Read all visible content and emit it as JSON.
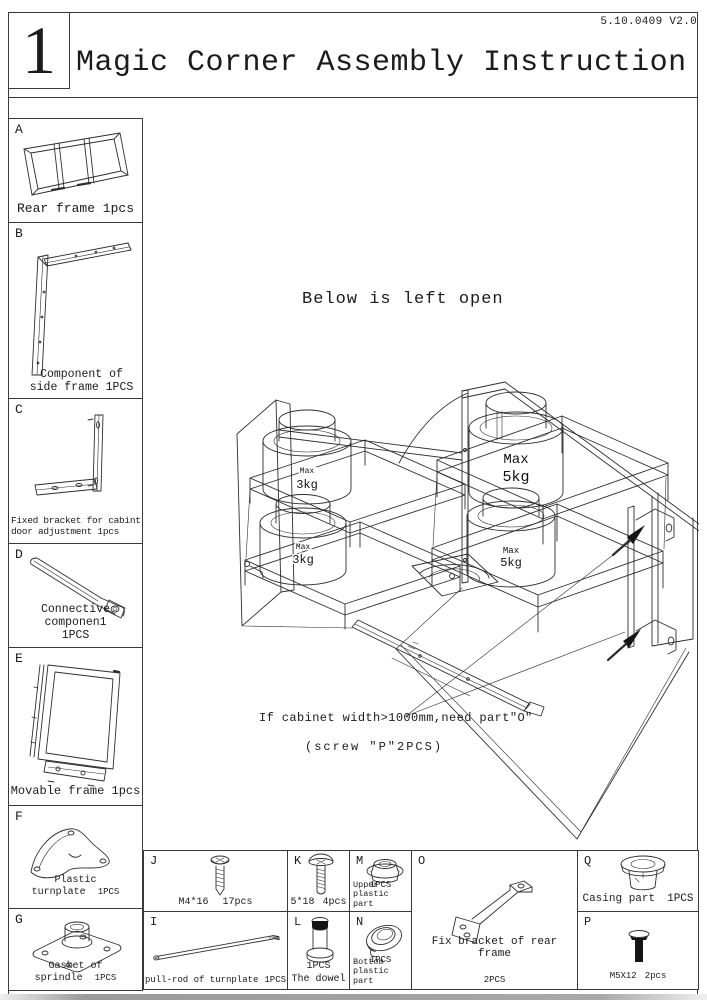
{
  "header": {
    "figure_number": "1",
    "title": "Magic Corner Assembly Instruction",
    "version": "5.10.0409 V2.0"
  },
  "side_parts": [
    {
      "id": "A",
      "caption": "Rear frame 1pcs"
    },
    {
      "id": "B",
      "caption": "Component of side frame 1PCS"
    },
    {
      "id": "C",
      "caption": "Fixed bracket for cabint door adjustment 1pcs"
    },
    {
      "id": "D",
      "caption": "Connective componen1",
      "qty": "1PCS"
    },
    {
      "id": "E",
      "caption": "Movable frame 1pcs"
    },
    {
      "id": "F",
      "caption": "Plastic turnplate",
      "qty": "1PCS"
    },
    {
      "id": "G",
      "caption": "Gasket of sprindle",
      "qty": "1PCS"
    }
  ],
  "bottom_parts": [
    {
      "id": "J",
      "label": "M4*16",
      "qty": "17pcs"
    },
    {
      "id": "K",
      "label": "5*18",
      "qty": "4pcs"
    },
    {
      "id": "M",
      "qty": "1PCS",
      "label": "Upper plastic part"
    },
    {
      "id": "O",
      "label": "Fix bracket of rear frame",
      "qty": "2PCS"
    },
    {
      "id": "Q",
      "label": "Casing part",
      "qty": "1PCS"
    },
    {
      "id": "I",
      "label": "pull-rod of turnplate",
      "qty": "1PCS"
    },
    {
      "id": "L",
      "qty": "1PCS",
      "label": "The dowel"
    },
    {
      "id": "N",
      "qty": "1PCS",
      "label": "Bottom plastic part"
    },
    {
      "id": "P",
      "label": "M5X12",
      "qty": "2pcs"
    }
  ],
  "diagram": {
    "note": "Below is left open",
    "annotation_line1": "If cabinet width>1000mm,need part\"O\"",
    "annotation_line2": "(screw \"P\"2PCS)",
    "weights": {
      "left": {
        "label": "Max",
        "value": "3kg"
      },
      "right": {
        "label": "Max",
        "value": "5kg"
      }
    }
  }
}
